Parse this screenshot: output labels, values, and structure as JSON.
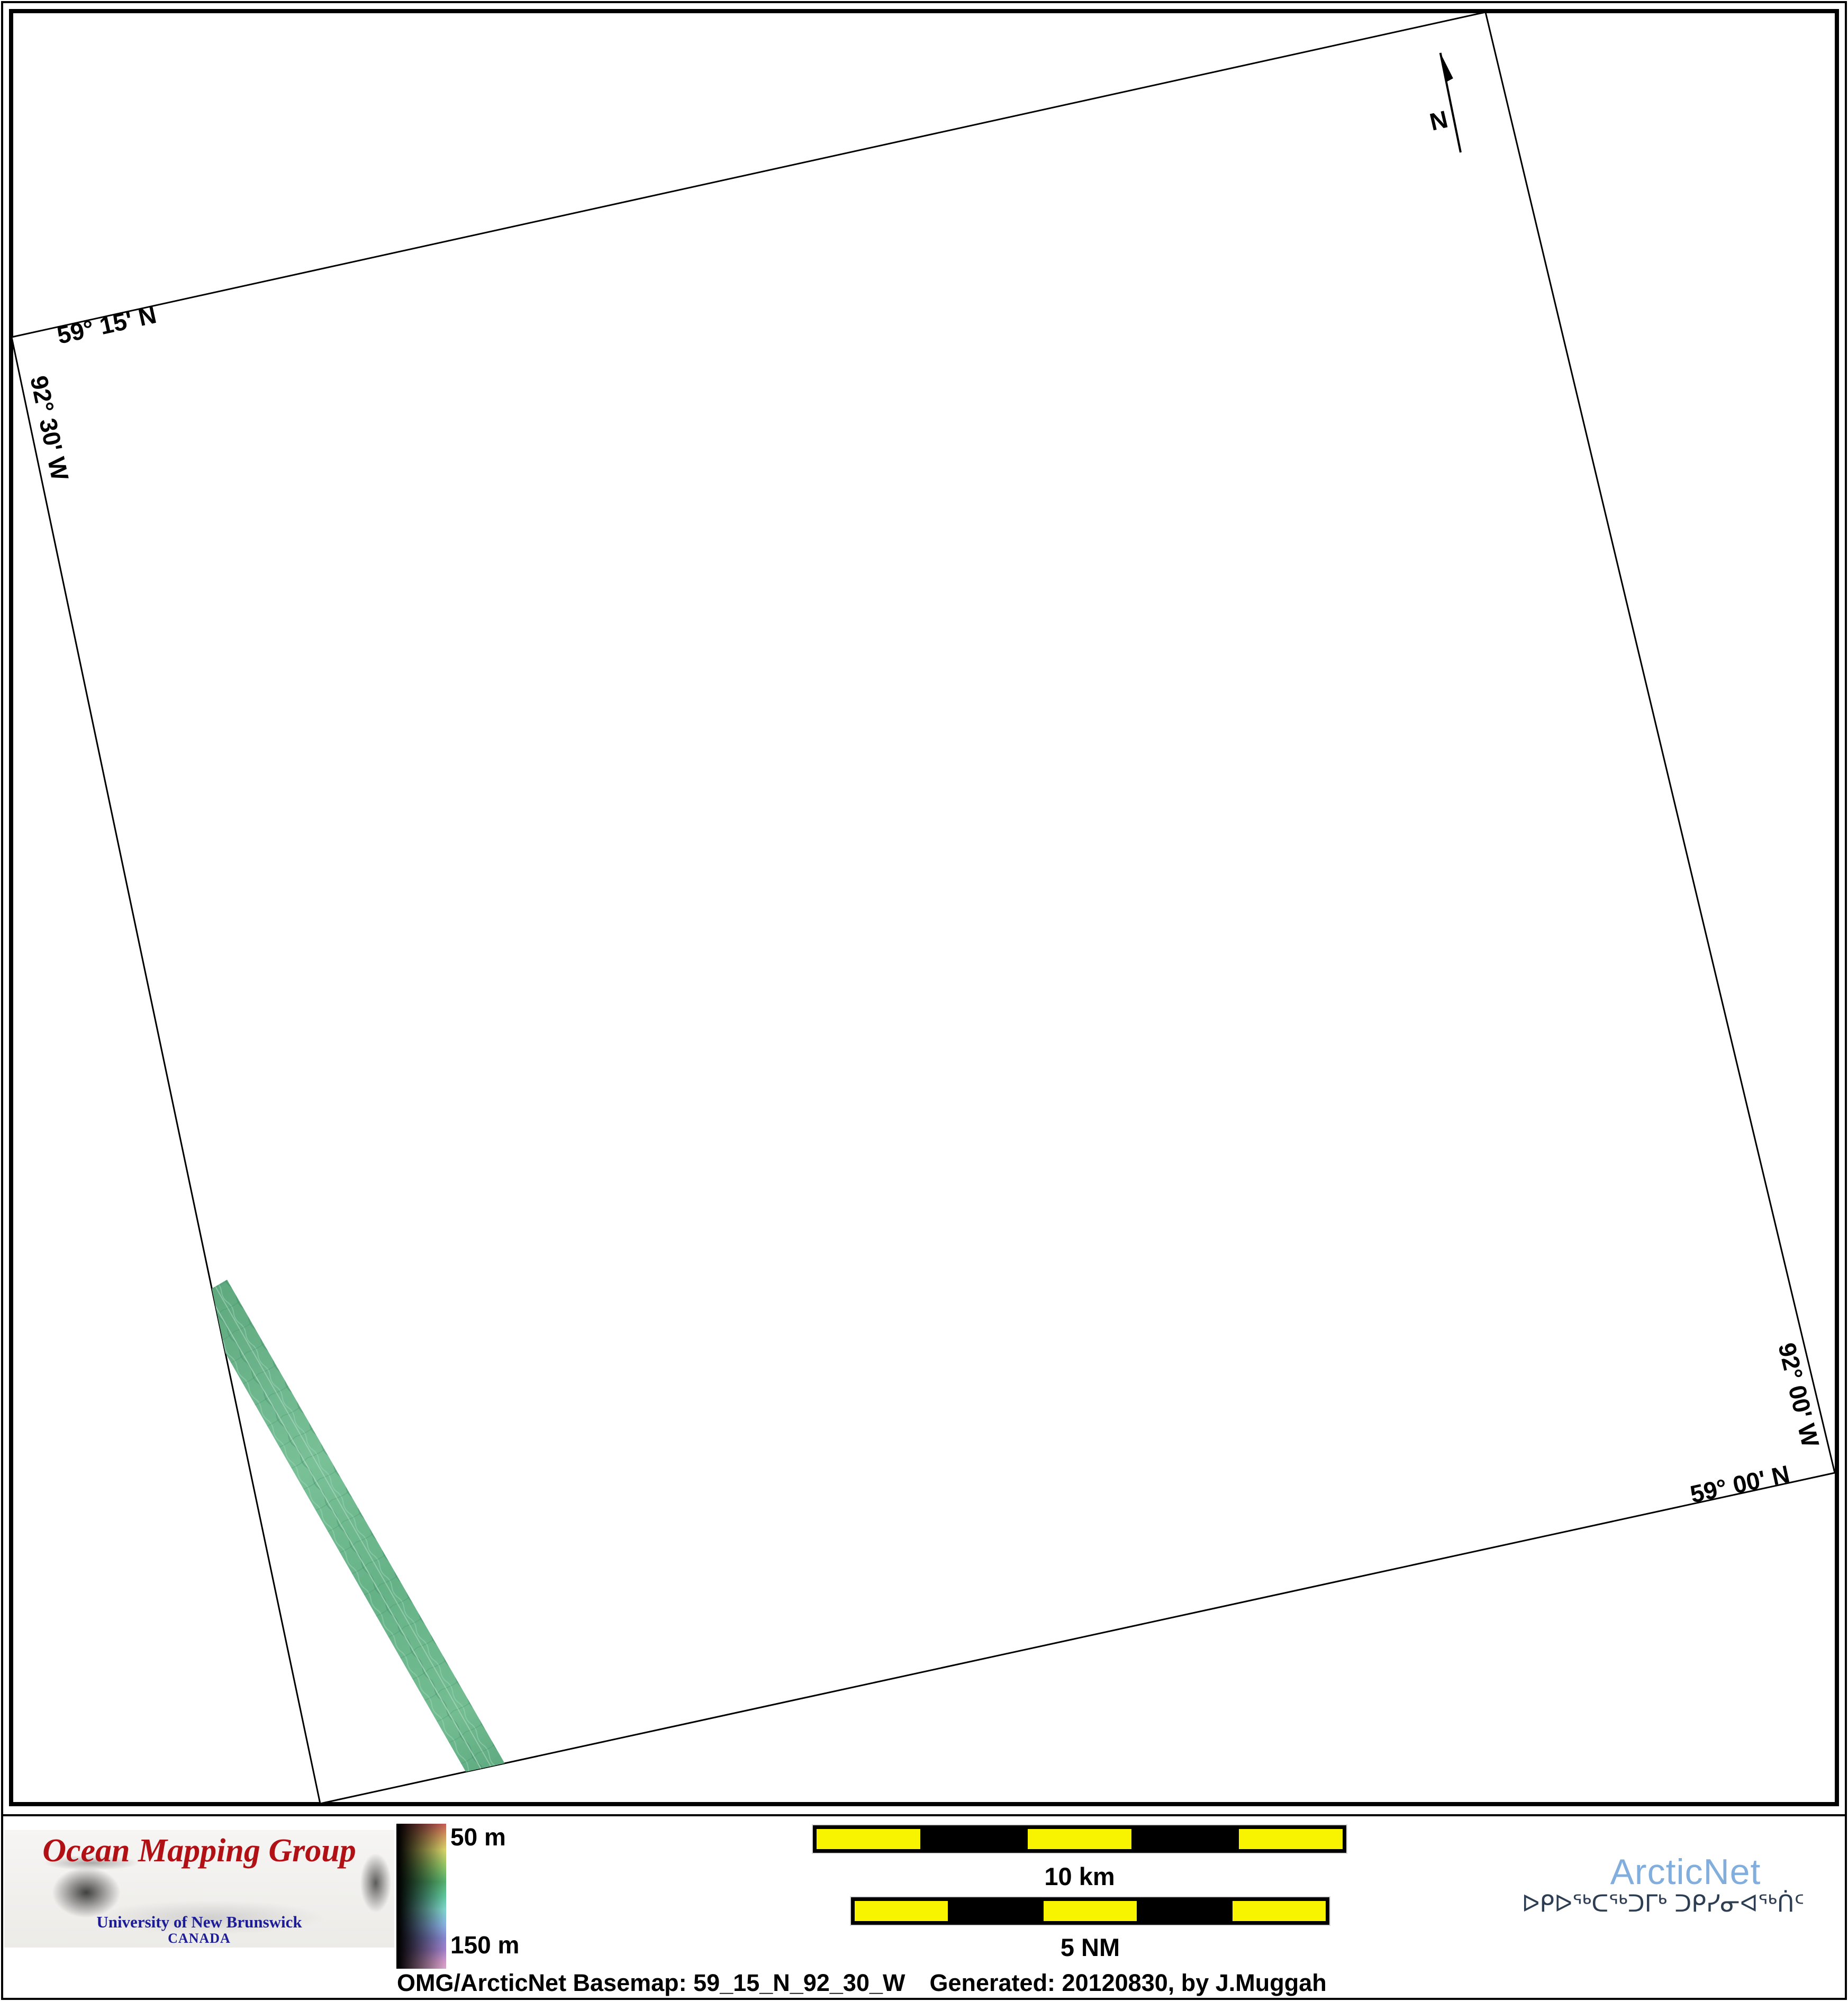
{
  "map": {
    "corner_labels": {
      "top_lat": "59° 15' N",
      "left_lon": "92° 30' W",
      "right_lon": "92° 00' W",
      "bottom_lat": "59° 00' N"
    },
    "north_arrow_label": "N",
    "swath_color": "#63b189"
  },
  "legend": {
    "shallow_label": "50 m",
    "deep_label": "150 m",
    "gradient_top_color": "#c35b55",
    "gradient_bottom_color": "#d8a3c8"
  },
  "scale_bars": {
    "km_label": "10 km",
    "nm_label": "5 NM",
    "yellow": "#f8f400",
    "black": "#000000"
  },
  "logos": {
    "omg": {
      "title": "Ocean Mapping Group",
      "university": "University of New Brunswick",
      "country": "CANADA",
      "title_color": "#b11015",
      "text_color": "#1c1c96"
    },
    "arcticnet": {
      "name": "ArcticNet",
      "inuktitut": "ᐅᑭᐅᖅᑕᖅᑐᒥᒃ ᑐᑭᓯᓂᐊᖅᑏᑦ",
      "name_color": "#82aedd"
    }
  },
  "footer": {
    "basemap_label": "OMG/ArcticNet Basemap: 59_15_N_92_30_W",
    "generated_label": "Generated: 20120830, by J.Muggah"
  }
}
